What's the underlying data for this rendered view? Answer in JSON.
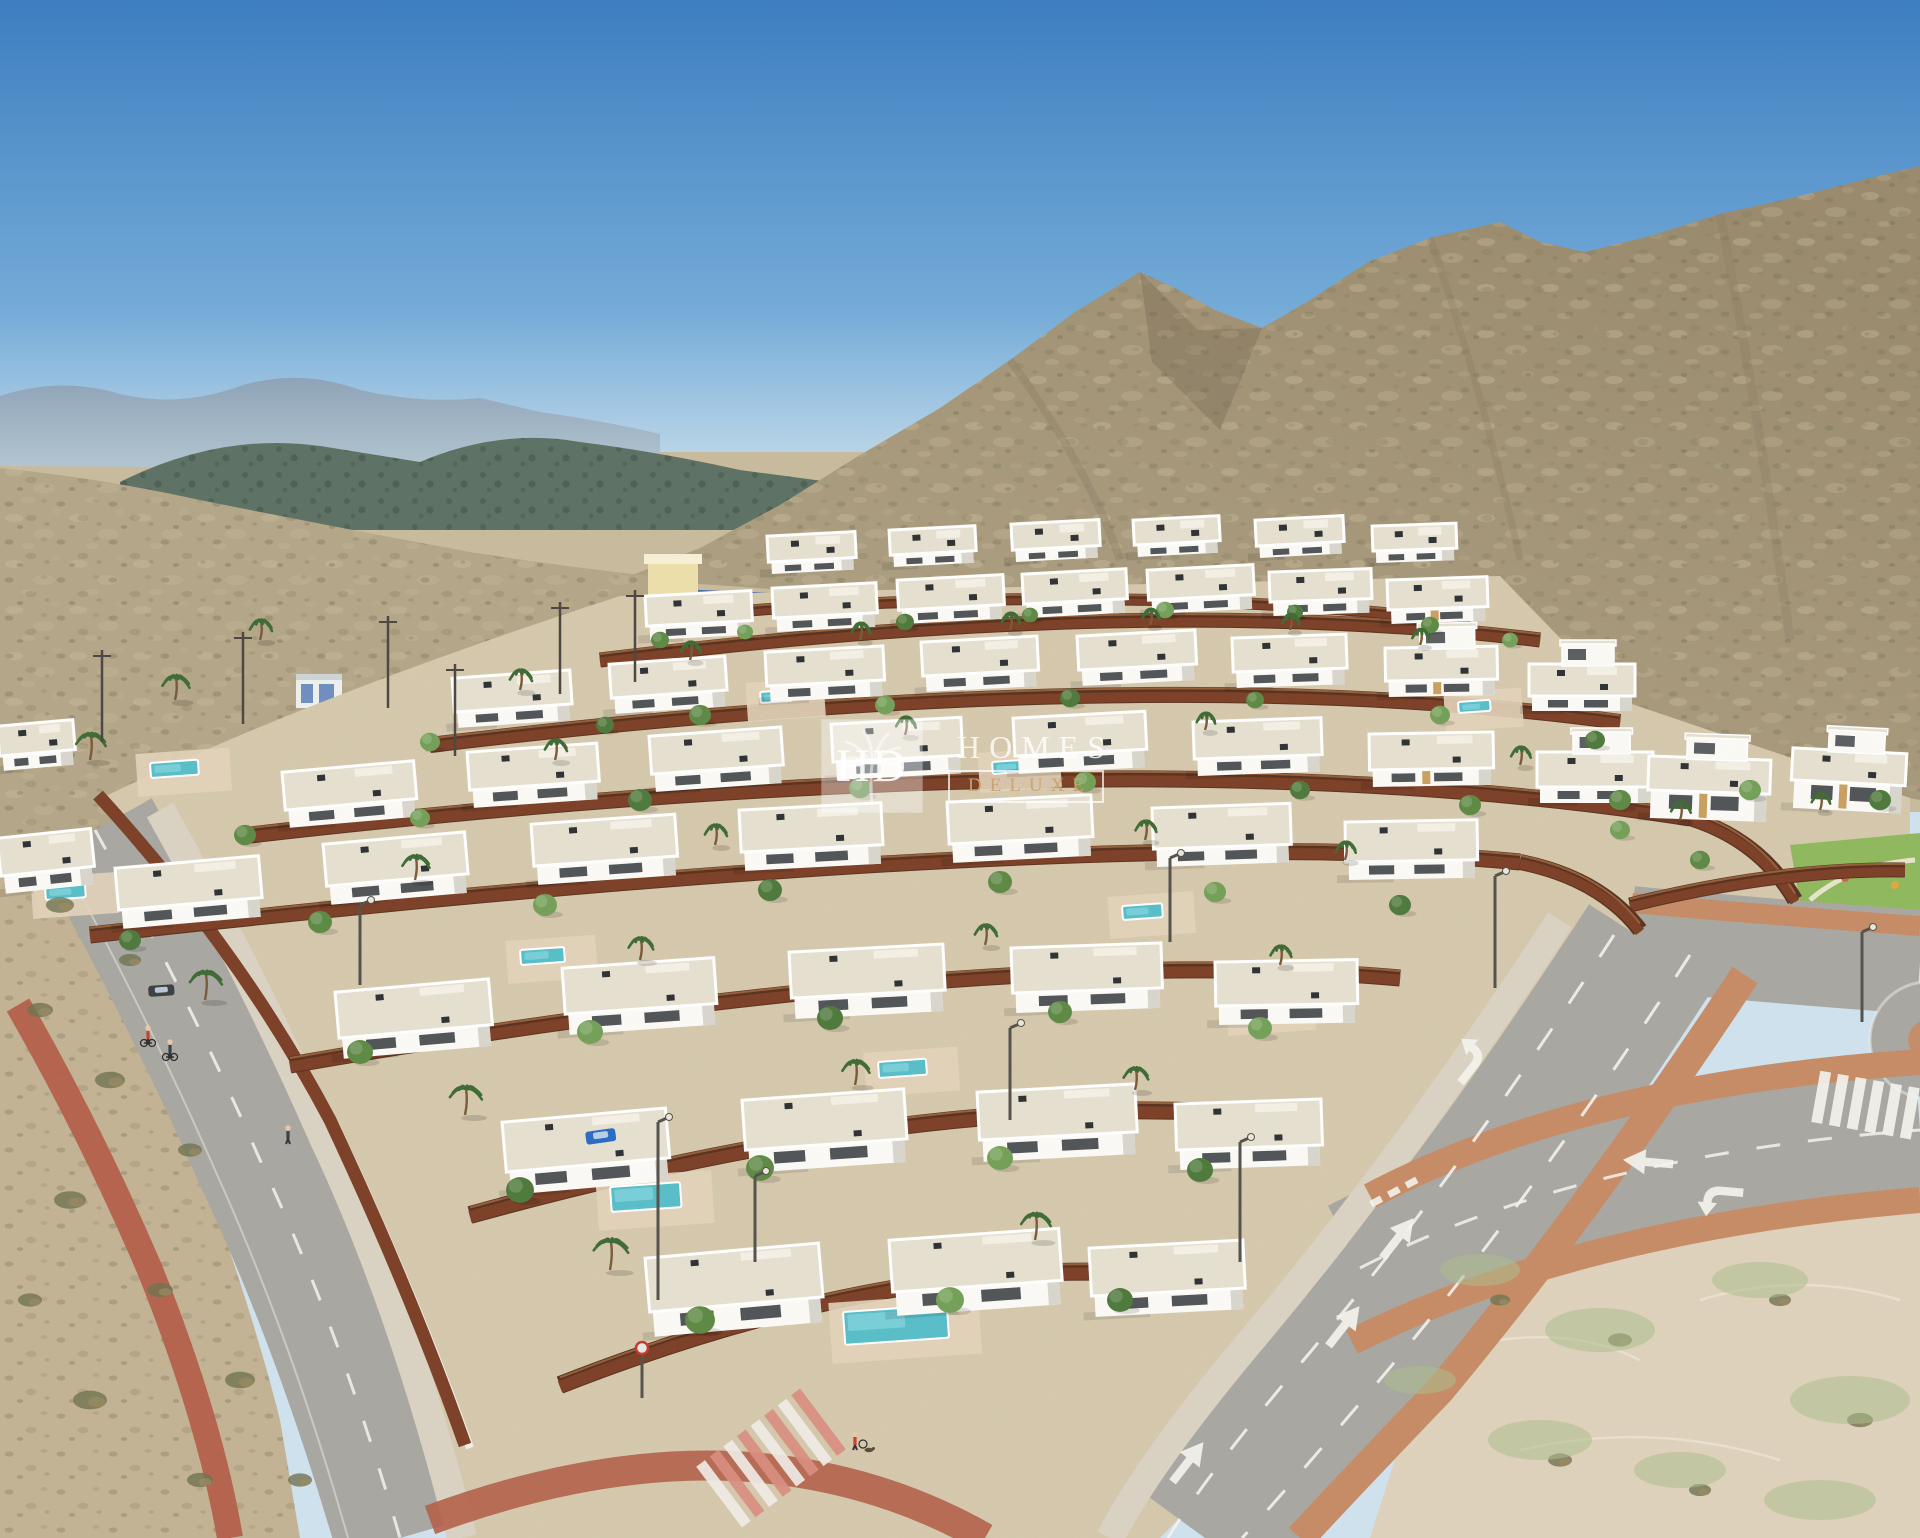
{
  "watermark": {
    "logo_text": "HD",
    "brand_line1": "HOMES",
    "brand_line2": "DELUXE",
    "palm_icon": "palm-tree-icon"
  },
  "palette": {
    "sky_top": "#3d7ec1",
    "sky_mid": "#74abd7",
    "sky_horizon": "#cfe2ee",
    "far_mountain": "#8ea3b7",
    "far_mountain_light": "#b3c6d2",
    "forest_hill": "#5d7164",
    "forest_dark": "#47584c",
    "mountain_lit": "#b4a688",
    "mountain_shade": "#9a8b6e",
    "mountain_dark": "#847660",
    "scrub_dark": "#6c6b4a",
    "scrub_light": "#d8cbab",
    "desert": "#c9bb9d",
    "dev_ground": "#d5c8ad",
    "scrub_left": "#c3b394",
    "sand_right": "#ded2bc",
    "sand_green": "#adbd8d",
    "fence": "#7c4027",
    "fence_top": "#a56a41",
    "fence_dark": "#5a331f",
    "villa_wall": "#fbfaf6",
    "villa_shade": "#d9d6cd",
    "villa_roof": "#e6e0d0",
    "window": "#3e4347",
    "patio": "#e2d3ba",
    "pool": "#58bec9",
    "pool_light": "#93dde3",
    "road": "#a9a7a2",
    "sidewalk": "#dad3c3",
    "kerb": "#c68c66",
    "bike_red": "#b4604a",
    "marking": "#f4f3ee",
    "lawn": "#8fb95e",
    "tree1": "#5e8a45",
    "tree2": "#74a058",
    "tree3": "#4f7a3c",
    "palm": "#3f6b35",
    "bush": "#6f7350",
    "dry": "#9b8a63",
    "facility_wall": "#eddfab",
    "facility_tan": "#c8a061",
    "facility_roof": "#3f6cb2",
    "shed": "#eef0ee",
    "shed_blue": "#6f8fc0",
    "car_blue": "#2b6bc4",
    "car_dark": "#3c4043",
    "figure_red": "#c9402f",
    "figure_dark": "#3a3f46",
    "skin": "#e8c9a8",
    "wm_white": "#ffffff",
    "wm_gold": "#c19a6b"
  },
  "scene": {
    "villas": [
      [
        770,
        536,
        82,
        26,
        12,
        "",
        -3
      ],
      [
        892,
        530,
        80,
        25,
        12,
        "",
        -3
      ],
      [
        1014,
        524,
        82,
        26,
        12,
        "",
        -3
      ],
      [
        1136,
        520,
        80,
        25,
        12,
        "",
        -3
      ],
      [
        1258,
        520,
        82,
        26,
        12,
        "",
        -3
      ],
      [
        1375,
        526,
        78,
        25,
        12,
        "",
        -2
      ],
      [
        648,
        596,
        100,
        30,
        14,
        "",
        -3
      ],
      [
        775,
        588,
        98,
        30,
        14,
        "",
        -3
      ],
      [
        900,
        580,
        100,
        30,
        14,
        "",
        -3
      ],
      [
        1025,
        574,
        98,
        30,
        14,
        "",
        -3
      ],
      [
        1150,
        570,
        100,
        30,
        14,
        "",
        -3
      ],
      [
        1272,
        572,
        96,
        30,
        14,
        "",
        -2
      ],
      [
        1390,
        580,
        94,
        30,
        14,
        "t",
        -2
      ],
      [
        455,
        678,
        112,
        34,
        16,
        "",
        -4
      ],
      [
        612,
        664,
        110,
        34,
        16,
        "",
        -4
      ],
      [
        768,
        652,
        112,
        34,
        16,
        "",
        -3
      ],
      [
        924,
        642,
        110,
        34,
        16,
        "",
        -3
      ],
      [
        1080,
        636,
        112,
        34,
        16,
        "",
        -3
      ],
      [
        1235,
        638,
        108,
        34,
        16,
        "",
        -2
      ],
      [
        1388,
        648,
        106,
        33,
        16,
        "t2",
        -1
      ],
      [
        1532,
        664,
        100,
        32,
        15,
        "2",
        0
      ],
      [
        0,
        726,
        70,
        30,
        15,
        "",
        -5
      ],
      [
        285,
        772,
        126,
        38,
        18,
        "",
        -5
      ],
      [
        470,
        752,
        124,
        38,
        18,
        "",
        -4
      ],
      [
        652,
        736,
        126,
        38,
        18,
        "",
        -4
      ],
      [
        834,
        724,
        124,
        38,
        18,
        "",
        -3
      ],
      [
        1016,
        718,
        126,
        38,
        18,
        "",
        -3
      ],
      [
        1196,
        722,
        122,
        37,
        17,
        "",
        -2
      ],
      [
        1372,
        734,
        118,
        36,
        17,
        "t",
        -1
      ],
      [
        1540,
        752,
        110,
        35,
        16,
        "2",
        0
      ],
      [
        1652,
        756,
        116,
        34,
        28,
        "2t",
        2
      ],
      [
        1796,
        748,
        108,
        32,
        28,
        "2t",
        3
      ],
      [
        0,
        838,
        88,
        38,
        18,
        "",
        -6
      ],
      [
        118,
        868,
        138,
        42,
        19,
        "",
        -5
      ],
      [
        326,
        844,
        136,
        42,
        19,
        "",
        -5
      ],
      [
        534,
        824,
        138,
        42,
        19,
        "",
        -4
      ],
      [
        742,
        810,
        136,
        42,
        19,
        "",
        -3
      ],
      [
        950,
        802,
        138,
        42,
        19,
        "",
        -3
      ],
      [
        1155,
        808,
        132,
        41,
        18,
        "",
        -2
      ],
      [
        1348,
        822,
        126,
        40,
        18,
        "",
        -1
      ],
      [
        338,
        992,
        148,
        46,
        21,
        "",
        -5
      ],
      [
        565,
        968,
        146,
        46,
        21,
        "",
        -4
      ],
      [
        792,
        952,
        148,
        46,
        21,
        "",
        -3
      ],
      [
        1014,
        948,
        144,
        45,
        20,
        "",
        -2
      ],
      [
        1218,
        962,
        136,
        44,
        19,
        "",
        -1
      ],
      [
        505,
        1122,
        158,
        50,
        23,
        "",
        -5
      ],
      [
        745,
        1100,
        156,
        50,
        23,
        "",
        -4
      ],
      [
        980,
        1092,
        152,
        48,
        22,
        "",
        -3
      ],
      [
        1178,
        1104,
        140,
        46,
        20,
        "",
        -2
      ],
      [
        648,
        1258,
        168,
        54,
        25,
        "",
        -5
      ],
      [
        892,
        1240,
        164,
        52,
        24,
        "",
        -4
      ],
      [
        1092,
        1248,
        148,
        48,
        21,
        "",
        -3
      ]
    ],
    "fences": [
      [
        655,
        618,
        1100,
        578,
        1470,
        622,
        9
      ],
      [
        600,
        660,
        1150,
        592,
        1540,
        640,
        12
      ],
      [
        430,
        745,
        1150,
        658,
        1620,
        722,
        13
      ],
      [
        250,
        835,
        1150,
        732,
        1690,
        818,
        14
      ],
      [
        1690,
        818,
        1760,
        840,
        1795,
        900,
        13
      ],
      [
        1630,
        905,
        1780,
        868,
        1905,
        870,
        12
      ],
      [
        90,
        935,
        1100,
        822,
        1520,
        862,
        14
      ],
      [
        1520,
        862,
        1600,
        878,
        1640,
        930,
        13
      ],
      [
        290,
        1065,
        1000,
        942,
        1400,
        978,
        14
      ],
      [
        470,
        1215,
        950,
        1082,
        1290,
        1118,
        15
      ],
      [
        560,
        1385,
        900,
        1252,
        1165,
        1275,
        15
      ]
    ],
    "pools": [
      [
        150,
        763,
        48,
        15
      ],
      [
        760,
        692,
        32,
        11
      ],
      [
        992,
        762,
        36,
        12
      ],
      [
        1458,
        702,
        32,
        11
      ],
      [
        45,
        887,
        40,
        13
      ],
      [
        358,
        858,
        36,
        12
      ],
      [
        1122,
        906,
        40,
        14
      ],
      [
        520,
        950,
        44,
        15
      ],
      [
        1240,
        1002,
        42,
        15
      ],
      [
        878,
        1062,
        48,
        16
      ],
      [
        610,
        1187,
        70,
        25
      ],
      [
        843,
        1312,
        104,
        33
      ]
    ],
    "trees": [
      [
        660,
        640,
        9,
        0
      ],
      [
        745,
        632,
        8,
        1
      ],
      [
        905,
        622,
        9,
        2
      ],
      [
        1030,
        615,
        8,
        0
      ],
      [
        1165,
        610,
        9,
        1
      ],
      [
        1295,
        612,
        8,
        2
      ],
      [
        1430,
        625,
        9,
        0
      ],
      [
        1510,
        640,
        8,
        1
      ],
      [
        430,
        742,
        10,
        1
      ],
      [
        605,
        725,
        9,
        2
      ],
      [
        700,
        715,
        11,
        0
      ],
      [
        885,
        705,
        10,
        1
      ],
      [
        1070,
        698,
        10,
        2
      ],
      [
        1255,
        700,
        9,
        0
      ],
      [
        1440,
        715,
        10,
        1
      ],
      [
        1595,
        740,
        10,
        2
      ],
      [
        245,
        835,
        11,
        0
      ],
      [
        420,
        818,
        10,
        1
      ],
      [
        640,
        800,
        12,
        2
      ],
      [
        860,
        788,
        11,
        0
      ],
      [
        1085,
        782,
        11,
        1
      ],
      [
        1300,
        790,
        10,
        2
      ],
      [
        1470,
        805,
        11,
        0
      ],
      [
        1620,
        830,
        10,
        1
      ],
      [
        130,
        940,
        11,
        2
      ],
      [
        320,
        922,
        12,
        0
      ],
      [
        545,
        905,
        12,
        1
      ],
      [
        770,
        890,
        12,
        2
      ],
      [
        1000,
        882,
        12,
        0
      ],
      [
        1215,
        892,
        11,
        1
      ],
      [
        1400,
        905,
        11,
        2
      ],
      [
        360,
        1052,
        13,
        0
      ],
      [
        590,
        1032,
        13,
        1
      ],
      [
        830,
        1018,
        13,
        2
      ],
      [
        1060,
        1012,
        12,
        0
      ],
      [
        1260,
        1028,
        12,
        1
      ],
      [
        520,
        1190,
        14,
        2
      ],
      [
        760,
        1168,
        14,
        0
      ],
      [
        1000,
        1158,
        13,
        1
      ],
      [
        1200,
        1170,
        13,
        2
      ],
      [
        700,
        1320,
        15,
        0
      ],
      [
        950,
        1300,
        14,
        1
      ],
      [
        1120,
        1300,
        13,
        2
      ],
      [
        1620,
        800,
        11,
        0
      ],
      [
        1750,
        790,
        11,
        1
      ],
      [
        1880,
        800,
        11,
        2
      ],
      [
        1700,
        860,
        10,
        0
      ]
    ],
    "palms": [
      [
        175,
        700,
        22
      ],
      [
        90,
        760,
        24
      ],
      [
        260,
        640,
        18
      ],
      [
        520,
        690,
        18
      ],
      [
        690,
        660,
        16
      ],
      [
        860,
        640,
        15
      ],
      [
        1010,
        630,
        15
      ],
      [
        1150,
        625,
        14
      ],
      [
        1290,
        630,
        14
      ],
      [
        1420,
        645,
        14
      ],
      [
        555,
        760,
        18
      ],
      [
        905,
        735,
        16
      ],
      [
        1205,
        730,
        15
      ],
      [
        1520,
        765,
        16
      ],
      [
        415,
        880,
        22
      ],
      [
        715,
        845,
        18
      ],
      [
        1145,
        840,
        17
      ],
      [
        1345,
        860,
        16
      ],
      [
        205,
        1000,
        26
      ],
      [
        640,
        960,
        20
      ],
      [
        985,
        945,
        18
      ],
      [
        1280,
        965,
        17
      ],
      [
        465,
        1115,
        26
      ],
      [
        855,
        1085,
        22
      ],
      [
        1135,
        1090,
        20
      ],
      [
        610,
        1270,
        28
      ],
      [
        1035,
        1240,
        24
      ],
      [
        1680,
        820,
        16
      ],
      [
        1820,
        810,
        15
      ]
    ],
    "cars": [
      [
        585,
        1132,
        30,
        13,
        "car_blue",
        -8
      ],
      [
        148,
        986,
        26,
        11,
        "car_dark",
        -4
      ]
    ],
    "lamps": [
      [
        658,
        1300,
        178
      ],
      [
        360,
        985,
        80
      ],
      [
        755,
        1262,
        86
      ],
      [
        1010,
        1120,
        92
      ],
      [
        1240,
        1262,
        120
      ],
      [
        1495,
        988,
        112
      ],
      [
        1170,
        942,
        84
      ],
      [
        1862,
        1022,
        90
      ]
    ],
    "figures": [
      [
        148,
        1040,
        "bike",
        "figure_red"
      ],
      [
        170,
        1054,
        "bike",
        "figure_dark"
      ],
      [
        855,
        1446,
        "walkdog",
        "figure_red"
      ],
      [
        288,
        1140,
        "walk",
        "figure_dark"
      ]
    ],
    "arrows": [
      [
        1398,
        1238,
        38,
        "s"
      ],
      [
        1344,
        1326,
        38,
        "s"
      ],
      [
        1188,
        1462,
        38,
        "s"
      ],
      [
        1648,
        1162,
        -85,
        "s"
      ],
      [
        1718,
        1192,
        -85,
        "t"
      ],
      [
        1475,
        1062,
        38,
        "t"
      ]
    ],
    "power_poles": [
      [
        102,
        650
      ],
      [
        243,
        632
      ],
      [
        388,
        616
      ],
      [
        455,
        664
      ],
      [
        560,
        602
      ],
      [
        635,
        590
      ]
    ],
    "bushes": [
      [
        60,
        905,
        14
      ],
      [
        130,
        960,
        11
      ],
      [
        40,
        1010,
        13
      ],
      [
        110,
        1080,
        15
      ],
      [
        190,
        1150,
        12
      ],
      [
        70,
        1200,
        16
      ],
      [
        160,
        1290,
        13
      ],
      [
        240,
        1380,
        15
      ],
      [
        90,
        1400,
        17
      ],
      [
        200,
        1480,
        13
      ],
      [
        300,
        1480,
        12
      ],
      [
        30,
        1300,
        12
      ],
      [
        1500,
        1300,
        10
      ],
      [
        1620,
        1340,
        12
      ],
      [
        1780,
        1300,
        11
      ],
      [
        1860,
        1420,
        13
      ],
      [
        1560,
        1460,
        12
      ],
      [
        1700,
        1490,
        11
      ]
    ],
    "sand_patches": [
      [
        1480,
        1270,
        40,
        16
      ],
      [
        1600,
        1330,
        55,
        22
      ],
      [
        1760,
        1280,
        48,
        18
      ],
      [
        1850,
        1400,
        60,
        24
      ],
      [
        1540,
        1440,
        52,
        20
      ],
      [
        1680,
        1470,
        46,
        18
      ],
      [
        1820,
        1500,
        56,
        20
      ],
      [
        1420,
        1380,
        36,
        14
      ]
    ]
  }
}
